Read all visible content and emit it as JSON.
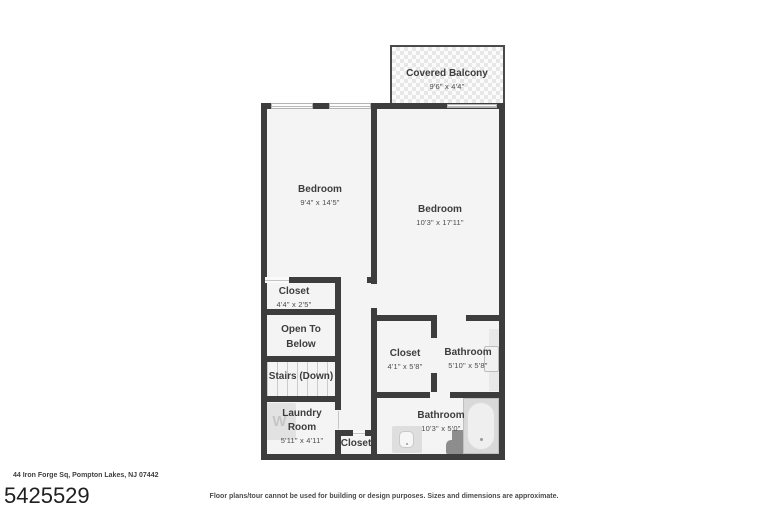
{
  "floor_plan": {
    "balcony": {
      "name": "Covered Balcony",
      "dims": "9'6\" x 4'4\""
    },
    "bedroom_left": {
      "name": "Bedroom",
      "dims": "9'4\" x 14'5\""
    },
    "bedroom_right": {
      "name": "Bedroom",
      "dims": "10'3\" x 17'11\""
    },
    "closet_upper": {
      "name": "Closet",
      "dims": "4'4\" x 2'5\""
    },
    "open_to_below": {
      "name": "Open To Below"
    },
    "stairs": {
      "name": "Stairs (Down)"
    },
    "laundry": {
      "name": "Laundry Room",
      "dims": "5'11\" x 4'11\""
    },
    "closet_hall": {
      "name": "Closet"
    },
    "closet_right": {
      "name": "Closet",
      "dims": "4'1\" x 5'8\""
    },
    "bathroom_upper": {
      "name": "Bathroom",
      "dims": "5'10\" x 5'8\""
    },
    "bathroom_lower": {
      "name": "Bathroom",
      "dims": "10'3\" x 5'0\""
    },
    "washer_letter": "W"
  },
  "footer": {
    "address": "44 Iron Forge Sq, Pompton Lakes, NJ 07442",
    "listing_number": "5425529",
    "disclaimer": "Floor plans/tour cannot be used for building or design purposes. Sizes and dimensions are approximate."
  },
  "colors": {
    "wall": "#3d3d3d",
    "room_fill": "#f4f4f4",
    "fixture_light": "#e2e2e2",
    "fixture_dark": "#8d8d8d",
    "text": "#3d3d3d"
  }
}
